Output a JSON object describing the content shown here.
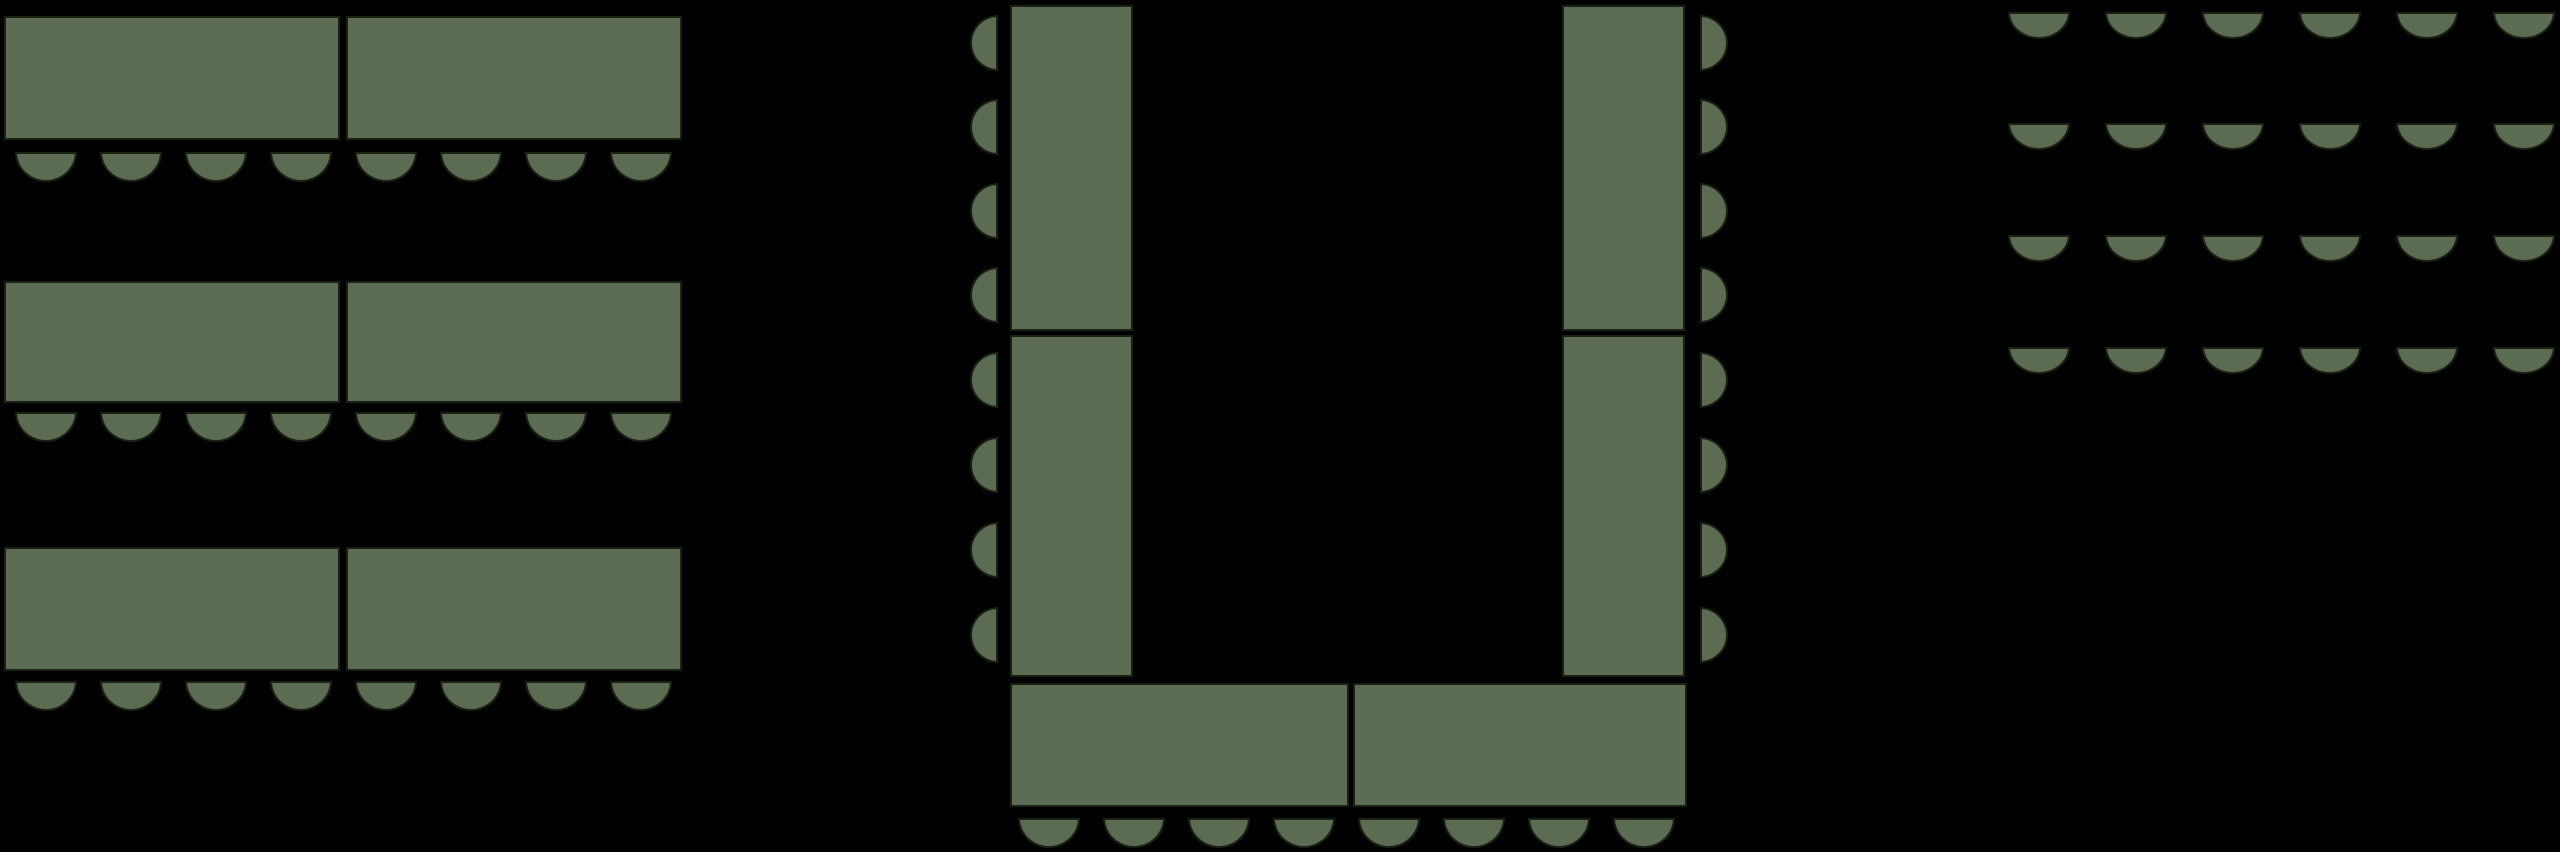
{
  "canvas": {
    "width": 2560,
    "height": 852,
    "background": "#000000"
  },
  "style": {
    "furniture_fill": "#5c6c52",
    "furniture_outline": "#1a2114",
    "outline_width": 2
  },
  "sections": [
    {
      "name": "banquet-rows",
      "description": "three rows of paired rectangular tables, eight seats below each row",
      "tables": [
        {
          "x": 4,
          "y": 16,
          "w": 336,
          "h": 124
        },
        {
          "x": 346,
          "y": 16,
          "w": 336,
          "h": 124
        },
        {
          "x": 4,
          "y": 281,
          "w": 336,
          "h": 122
        },
        {
          "x": 346,
          "y": 281,
          "w": 336,
          "h": 122
        },
        {
          "x": 4,
          "y": 547,
          "w": 336,
          "h": 124
        },
        {
          "x": 346,
          "y": 547,
          "w": 336,
          "h": 124
        }
      ],
      "seat_runs": [
        {
          "direction": "down",
          "x": 15,
          "y": 152,
          "count": 8,
          "pitch": 85,
          "seat_w": 62,
          "seat_h": 30
        },
        {
          "direction": "down",
          "x": 15,
          "y": 412,
          "count": 8,
          "pitch": 85,
          "seat_w": 62,
          "seat_h": 30
        },
        {
          "direction": "down",
          "x": 15,
          "y": 681,
          "count": 8,
          "pitch": 85,
          "seat_w": 62,
          "seat_h": 30
        }
      ]
    },
    {
      "name": "u-shape",
      "description": "U-shaped arrangement of six tables with seats along the outer edges",
      "tables": [
        {
          "x": 1010,
          "y": 5,
          "w": 123,
          "h": 326
        },
        {
          "x": 1010,
          "y": 335,
          "w": 123,
          "h": 342
        },
        {
          "x": 1562,
          "y": 5,
          "w": 123,
          "h": 326
        },
        {
          "x": 1562,
          "y": 335,
          "w": 123,
          "h": 342
        },
        {
          "x": 1010,
          "y": 683,
          "w": 339,
          "h": 124
        },
        {
          "x": 1353,
          "y": 683,
          "w": 334,
          "h": 124
        }
      ],
      "seat_runs": [
        {
          "direction": "left",
          "x": 970,
          "y": 15,
          "count": 4,
          "pitch": 84,
          "seat_w": 28,
          "seat_h": 56
        },
        {
          "direction": "left",
          "x": 970,
          "y": 352,
          "count": 4,
          "pitch": 85,
          "seat_w": 28,
          "seat_h": 56
        },
        {
          "direction": "right",
          "x": 1700,
          "y": 15,
          "count": 4,
          "pitch": 84,
          "seat_w": 28,
          "seat_h": 56
        },
        {
          "direction": "right",
          "x": 1700,
          "y": 352,
          "count": 4,
          "pitch": 85,
          "seat_w": 28,
          "seat_h": 56
        },
        {
          "direction": "down",
          "x": 1018,
          "y": 818,
          "count": 8,
          "pitch": 85,
          "seat_w": 62,
          "seat_h": 30
        }
      ]
    },
    {
      "name": "theater",
      "description": "four rows of six seats with no tables",
      "tables": [],
      "seat_runs": [
        {
          "direction": "down",
          "x": 2008,
          "y": 12,
          "count": 6,
          "pitch": 97,
          "seat_w": 62,
          "seat_h": 27
        },
        {
          "direction": "down",
          "x": 2008,
          "y": 123,
          "count": 6,
          "pitch": 97,
          "seat_w": 62,
          "seat_h": 27
        },
        {
          "direction": "down",
          "x": 2008,
          "y": 235,
          "count": 6,
          "pitch": 97,
          "seat_w": 62,
          "seat_h": 27
        },
        {
          "direction": "down",
          "x": 2008,
          "y": 347,
          "count": 6,
          "pitch": 97,
          "seat_w": 62,
          "seat_h": 27
        }
      ]
    }
  ]
}
